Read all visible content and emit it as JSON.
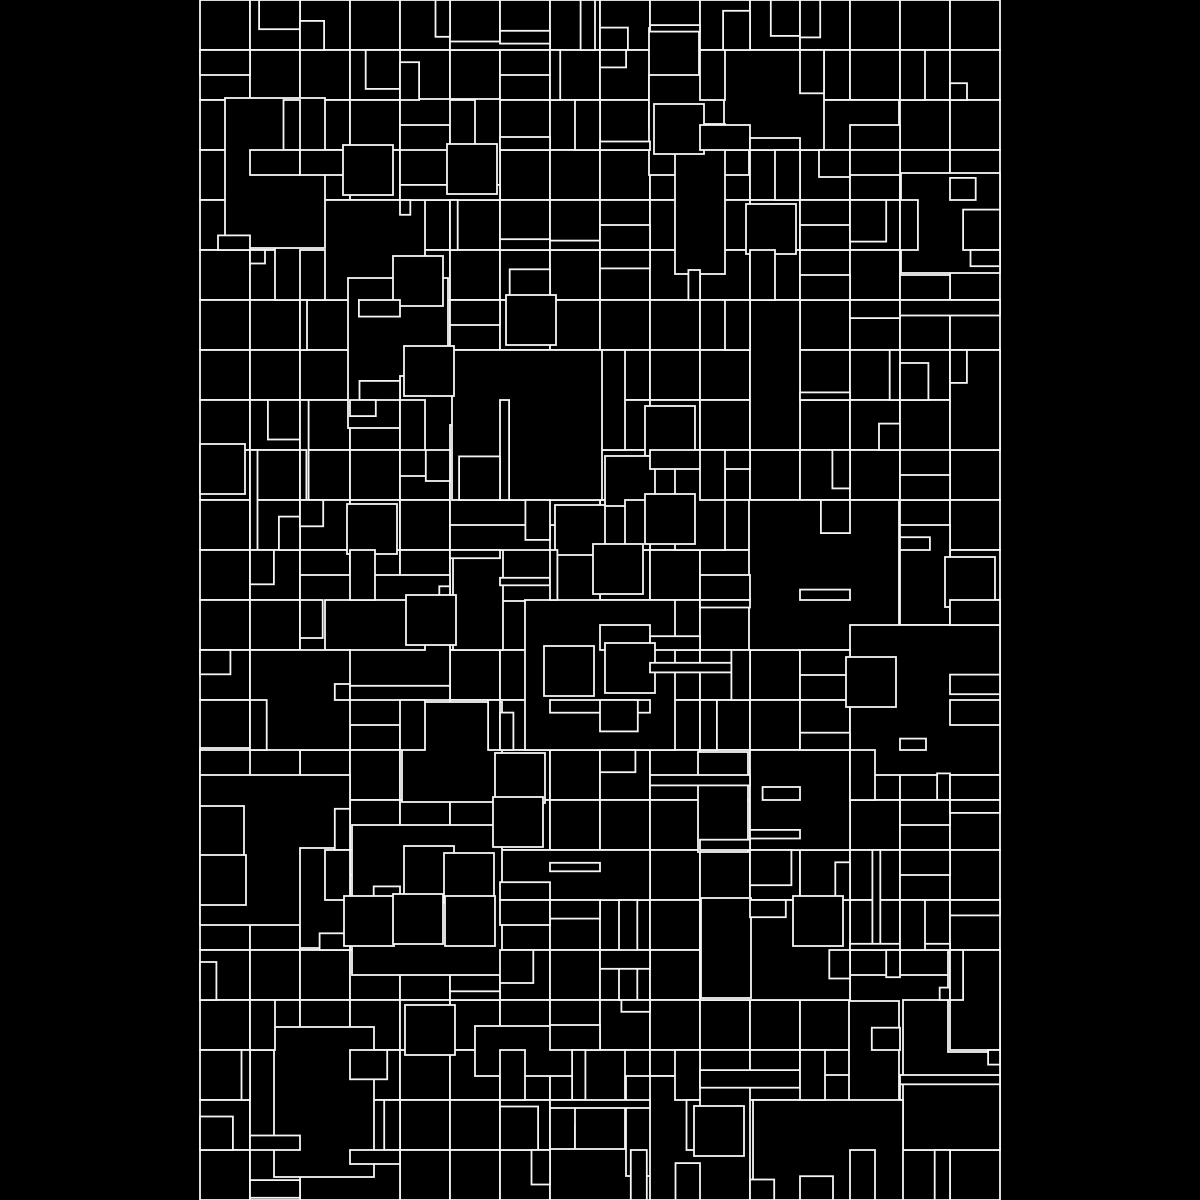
{
  "artwork": {
    "name": "generative-rectangle-grid",
    "description_type": "abstract-generative-pattern",
    "background_color": "#000000",
    "fill_color": "#000000",
    "stroke_color": "#f5f5f5",
    "stroke_width": 1.8,
    "canvas": {
      "width": 1200,
      "height": 1200
    },
    "panel": {
      "x": 200,
      "y": 0,
      "width": 800,
      "height": 1200
    },
    "grid": {
      "cols": 16,
      "rows": 24,
      "cell": 50
    },
    "seed": 73,
    "big_blocks": {
      "count": 62,
      "span_choices": [
        1,
        2,
        2,
        3
      ],
      "half_cell_offset_prob": 0.35,
      "jitter_prob": 0.35,
      "jitter_max": 3
    },
    "cell_details": {
      "probability": 0.55,
      "corner_min": 10,
      "corner_max": 44,
      "sliver_min": 6,
      "sliver_max": 20,
      "two_cell_sliver_prob": 0.3,
      "offset_dup_min": 3,
      "offset_dup_max": 7
    }
  }
}
